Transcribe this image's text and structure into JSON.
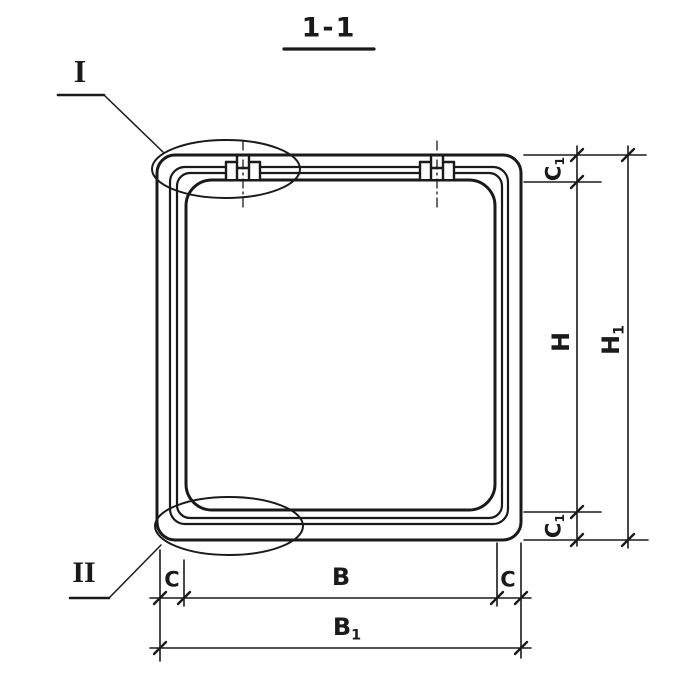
{
  "drawing": {
    "section_title": "1-1",
    "callouts": {
      "detail_top": "I",
      "detail_bottom": "II"
    },
    "dimensions": {
      "c_left": {
        "base": "C",
        "sub": ""
      },
      "b": {
        "base": "B",
        "sub": ""
      },
      "c_right": {
        "base": "C",
        "sub": ""
      },
      "b1": {
        "base": "B",
        "sub": "1"
      },
      "c1_top": {
        "base": "C",
        "sub": "1"
      },
      "h": {
        "base": "H",
        "sub": ""
      },
      "h1": {
        "base": "H",
        "sub": "1"
      },
      "c1_bottom": {
        "base": "C",
        "sub": "1"
      }
    },
    "colors": {
      "ink": "#1a1a1a",
      "paper": "#ffffff"
    }
  }
}
